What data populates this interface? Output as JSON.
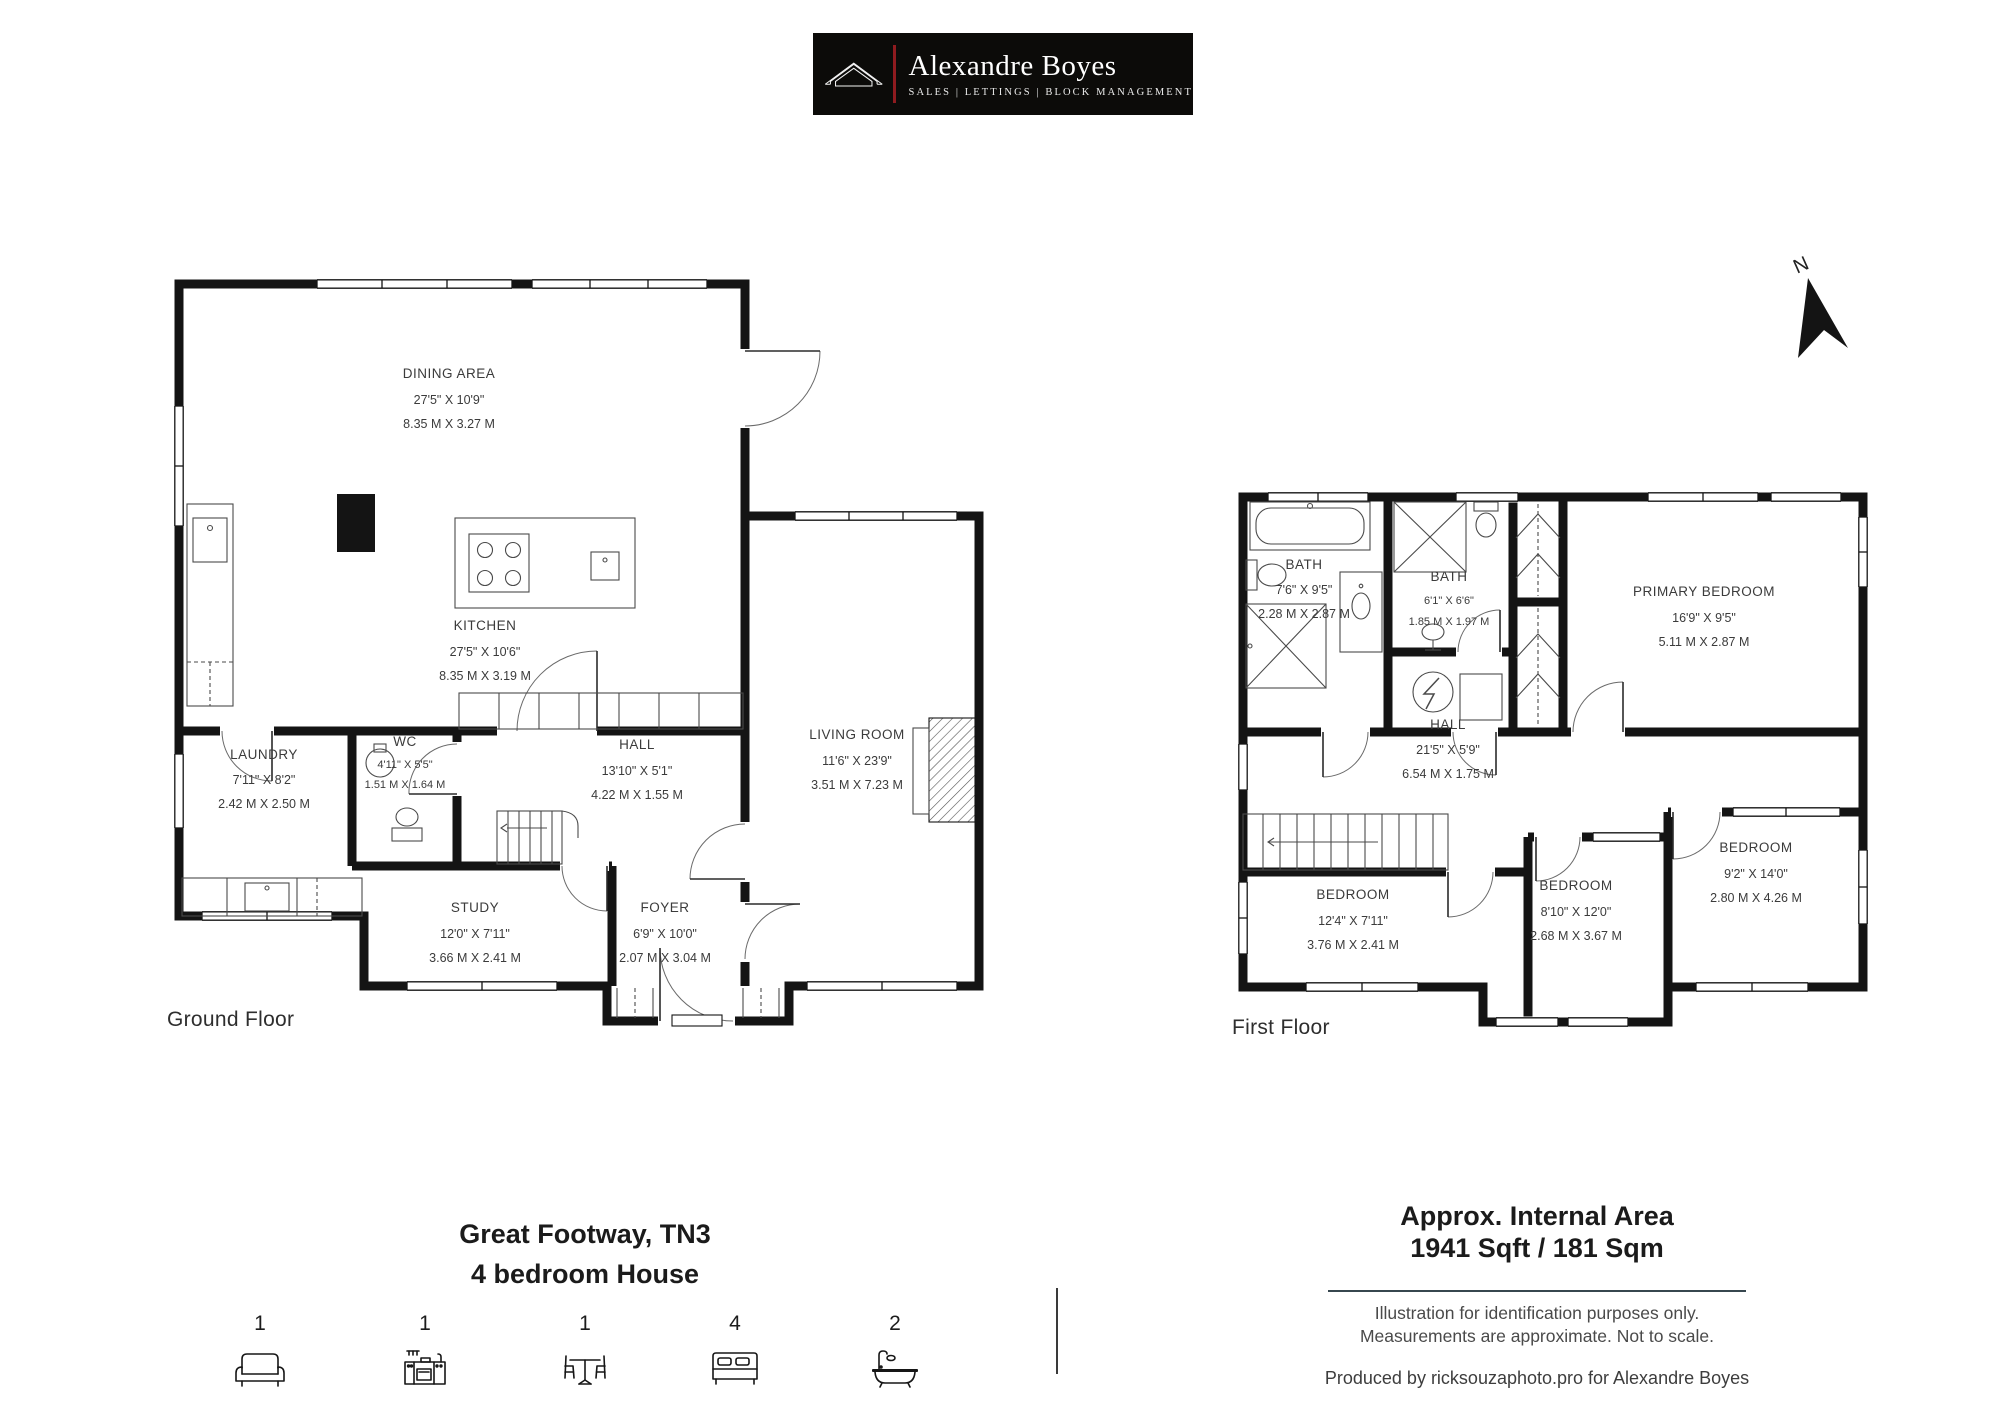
{
  "header": {
    "brand": "Alexandre Boyes",
    "tagline": "SALES | LETTINGS | BLOCK MANAGEMENT",
    "accent_color": "#8f1b1f",
    "bg_color": "#0c0b09"
  },
  "north_label": "N",
  "floors": {
    "ground": {
      "label": "Ground Floor",
      "rooms": [
        {
          "name": "DINING AREA",
          "dim_ft": "27'5\" X 10'9\"",
          "dim_m": "8.35 M X 3.27 M"
        },
        {
          "name": "KITCHEN",
          "dim_ft": "27'5\" X 10'6\"",
          "dim_m": "8.35 M X 3.19 M"
        },
        {
          "name": "LAUNDRY",
          "dim_ft": "7'11\" X 8'2\"",
          "dim_m": "2.42 M X 2.50 M"
        },
        {
          "name": "WC",
          "dim_ft": "4'11\" X 5'5\"",
          "dim_m": "1.51 M X 1.64 M"
        },
        {
          "name": "HALL",
          "dim_ft": "13'10\" X 5'1\"",
          "dim_m": "4.22 M X 1.55 M"
        },
        {
          "name": "LIVING ROOM",
          "dim_ft": "11'6\" X 23'9\"",
          "dim_m": "3.51 M X 7.23 M"
        },
        {
          "name": "STUDY",
          "dim_ft": "12'0\" X 7'11\"",
          "dim_m": "3.66 M X 2.41 M"
        },
        {
          "name": "FOYER",
          "dim_ft": "6'9\" X 10'0\"",
          "dim_m": "2.07 M X 3.04 M"
        }
      ]
    },
    "first": {
      "label": "First Floor",
      "rooms": [
        {
          "name": "BATH",
          "dim_ft": "7'6\" X 9'5\"",
          "dim_m": "2.28 M X 2.87 M"
        },
        {
          "name": "BATH",
          "dim_ft": "6'1\" X 6'6\"",
          "dim_m": "1.85 M X 1.97 M"
        },
        {
          "name": "PRIMARY BEDROOM",
          "dim_ft": "16'9\" X 9'5\"",
          "dim_m": "5.11 M X 2.87 M"
        },
        {
          "name": "HALL",
          "dim_ft": "21'5\" X 5'9\"",
          "dim_m": "6.54 M X 1.75 M"
        },
        {
          "name": "BEDROOM",
          "dim_ft": "12'4\" X 7'11\"",
          "dim_m": "3.76 M X 2.41 M"
        },
        {
          "name": "BEDROOM",
          "dim_ft": "8'10\" X 12'0\"",
          "dim_m": "2.68 M X 3.67 M"
        },
        {
          "name": "BEDROOM",
          "dim_ft": "9'2\" X 14'0\"",
          "dim_m": "2.80 M X 4.26 M"
        }
      ]
    }
  },
  "footer": {
    "address_line1": "Great Footway, TN3",
    "address_line2": "4 bedroom House",
    "counts": [
      {
        "icon": "sofa-icon",
        "label": "1"
      },
      {
        "icon": "kitchen-icon",
        "label": "1"
      },
      {
        "icon": "dining-icon",
        "label": "1"
      },
      {
        "icon": "bed-icon",
        "label": "4"
      },
      {
        "icon": "bath-icon",
        "label": "2"
      }
    ],
    "area_title": "Approx. Internal Area",
    "area_value": "1941 Sqft / 181 Sqm",
    "disclaimer1": "Illustration for identification purposes only.",
    "disclaimer2": "Measurements are approximate. Not to scale.",
    "credit": "Produced by ricksouzaphoto.pro for Alexandre Boyes"
  }
}
